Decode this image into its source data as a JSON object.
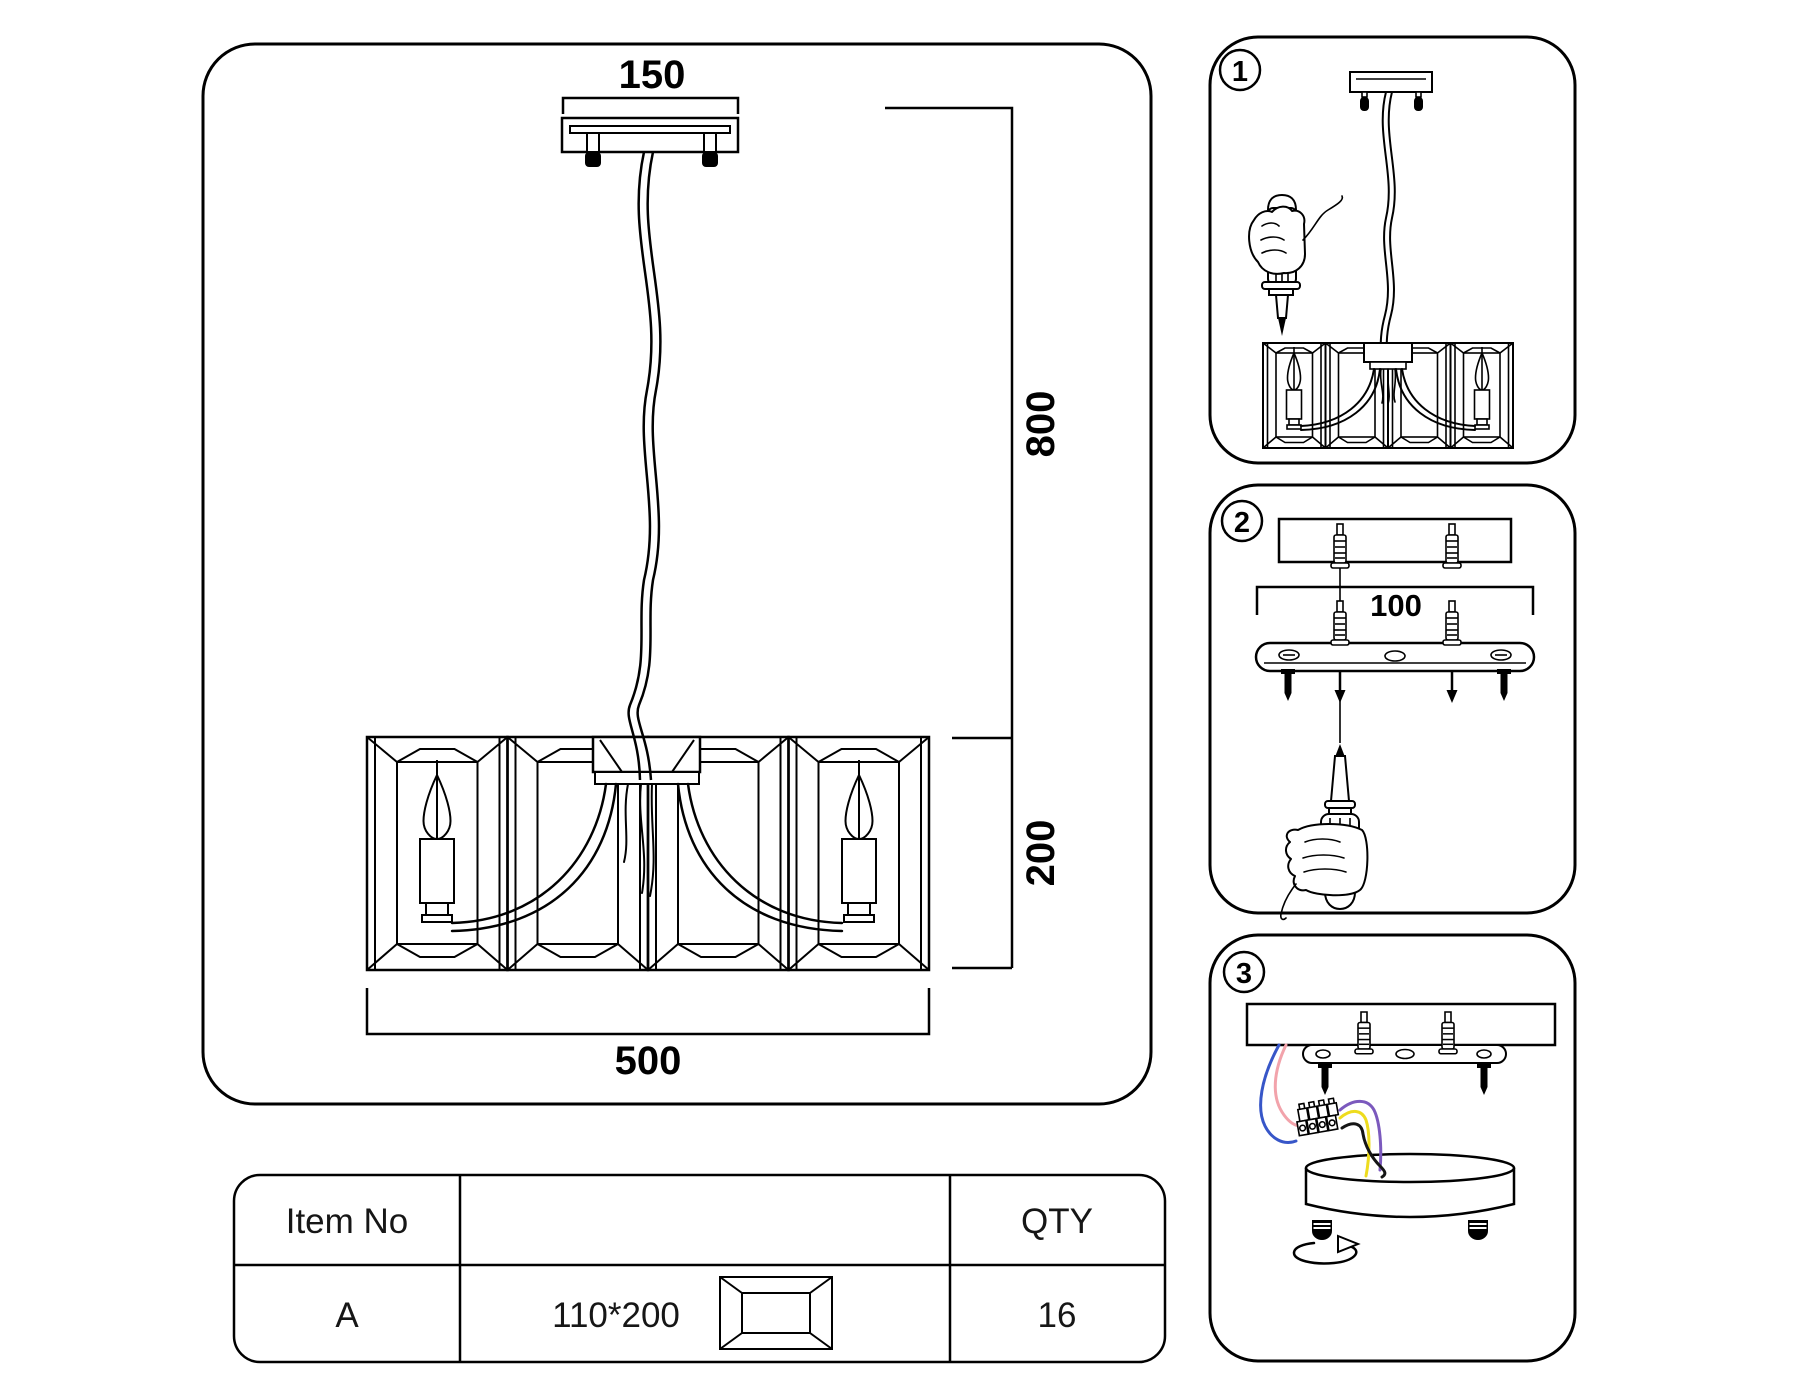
{
  "page": {
    "background": "#ffffff",
    "line_color": "#000000",
    "description": "Chandelier mounting instruction sheet"
  },
  "main_diagram": {
    "canopy_width_label": "150",
    "suspension_height_label": "800",
    "shade_height_label": "200",
    "shade_width_label": "500"
  },
  "steps": {
    "step1": {
      "number": "1"
    },
    "step2": {
      "number": "2",
      "hole_spacing_label": "100"
    },
    "step3": {
      "number": "3"
    }
  },
  "parts_table": {
    "header": {
      "item_col": "Item No",
      "qty_col": "QTY"
    },
    "row": {
      "item_no": "A",
      "crystal_size": "110*200",
      "qty": "16"
    }
  },
  "wire_colors": {
    "blue": "#3756c8",
    "pink": "#f2a3ab",
    "purple": "#7b59bd",
    "yellow": "#eedc1e",
    "black": "#151515"
  },
  "icons": {
    "step-badge": "circled-number",
    "crystal-panel-icon": "beveled-rectangle-crystal",
    "candle-icon": "candle-bulb-flame",
    "ceiling-canopy-icon": "mounting-plate-with-hooks",
    "suspension-cable-icon": "wavy-double-cable",
    "screwdriver-icon": "flat-screwdriver",
    "hand-icon": "gripping-hand",
    "wall-anchor-icon": "ribbed-dowel-plug",
    "screw-icon": "black-bolt",
    "arrow-down-icon": "▼",
    "rotate-arrow-icon": "↻",
    "terminal-block-icon": "screw-terminal-strip",
    "round-canopy-icon": "cylinder-drum"
  }
}
